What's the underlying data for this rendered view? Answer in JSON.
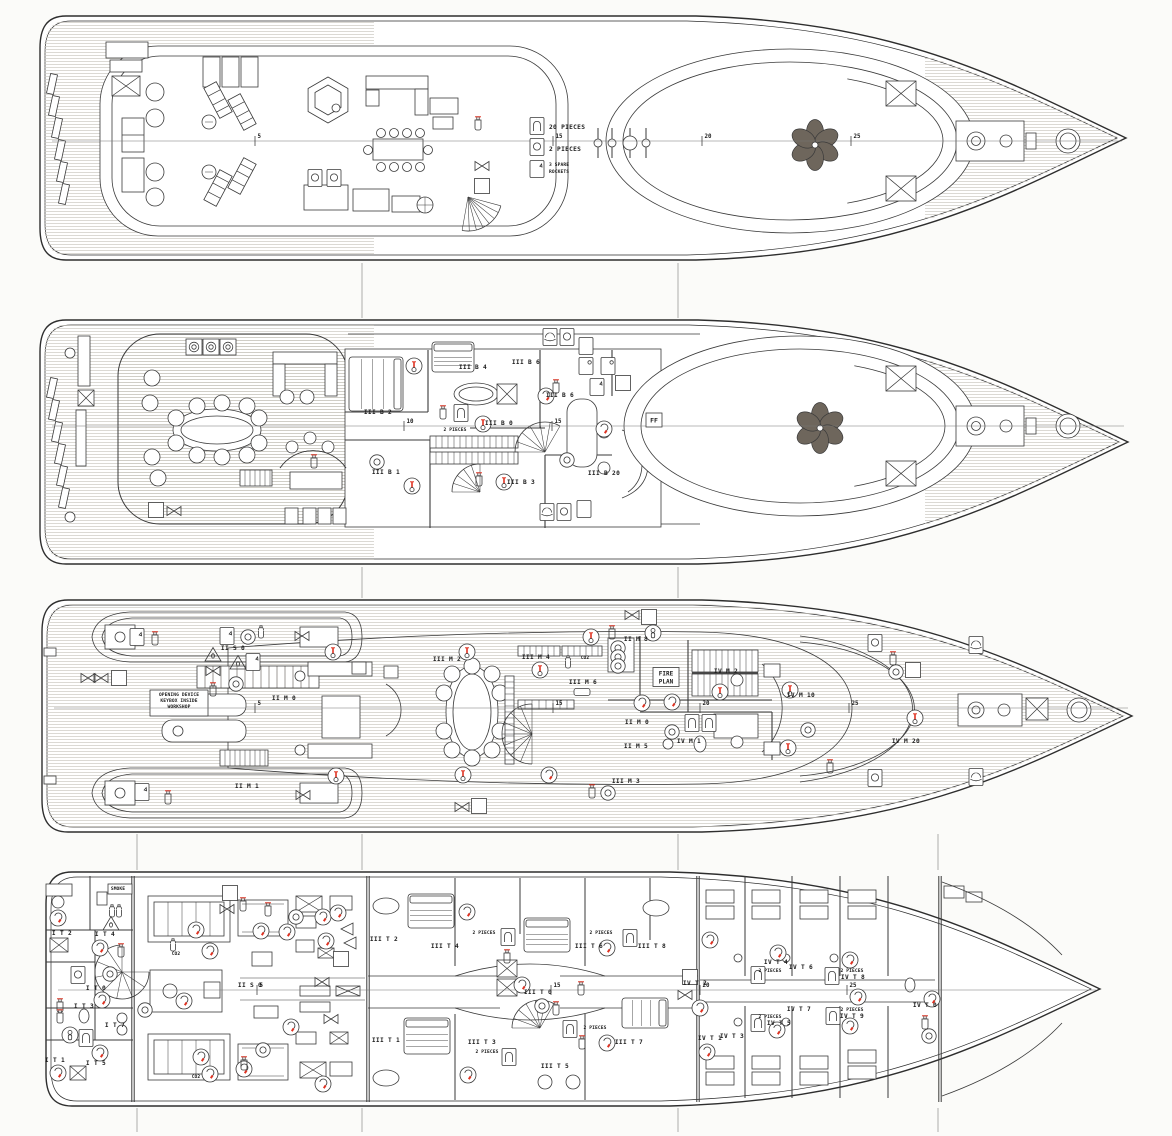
{
  "colors": {
    "line": "#3a3a3a",
    "red": "#df3222",
    "green": "#15673a",
    "green_dark": "#0c3f22",
    "blue": "#2f63b5",
    "band": "#50473e",
    "dark_furniture": "#6e665c",
    "yellow": "#edbd1a",
    "teak_line": "#c9c7bf",
    "paper": "#fbfbf9"
  },
  "symbol_key": {
    "ext": "fire-extinguisher-icon",
    "hose": "fire-hose-reel-icon",
    "hyd": "hydrant-valve-icon",
    "heat": "heat-detector-icon",
    "smoke": "smoke-detector-icon",
    "call": "alarm-call-point-icon",
    "callb": "alarm-call-point-icon",
    "co2": "co2-cylinder-icon",
    "ff": "fireman-outfit-icon",
    "tri": "fire-damper-icon",
    "blk": "emergency-shutoff-icon",
    "blue": "breathing-apparatus-icon",
    "g_lj": "lifejackets-locker-icon",
    "g_lb": "lifebuoy-icon",
    "g_lr": "liferaft-icon",
    "g_ladder": "escape-ladder-icon",
    "g_flare": "distress-rockets-icon",
    "g_lta": "line-throwing-appliance-icon",
    "g_exit": "emergency-exit-icon",
    "fireplan": "fire-plan-box-icon",
    "yellow": "first-aid-kit-icon"
  },
  "decks": [
    {
      "id": "deck-1",
      "centerline_y": 141,
      "frames": [
        {
          "n": "5",
          "x": 255
        },
        {
          "n": "15",
          "x": 553
        },
        {
          "n": "20",
          "x": 702
        },
        {
          "n": "25",
          "x": 851
        }
      ],
      "symbols": [
        [
          "ext",
          478,
          123
        ],
        [
          "hyd",
          482,
          166
        ],
        [
          "hose",
          482,
          186
        ],
        [
          "g_lj",
          537,
          126
        ],
        [
          "g_lb",
          537,
          147
        ],
        [
          "g_flare",
          537,
          169
        ],
        [
          "g_lb",
          315,
          178
        ],
        [
          "g_lb",
          334,
          178
        ]
      ],
      "labels": [
        [
          "20 PIECES",
          549,
          129,
          "s"
        ],
        [
          "2 PIECES",
          549,
          151,
          "s"
        ],
        [
          "3 SPARE",
          549,
          166,
          "s",
          "xs"
        ],
        [
          "ROCKETS",
          549,
          173,
          "s",
          "xs"
        ]
      ]
    },
    {
      "id": "deck-2",
      "centerline_y": 426,
      "frames": [
        {
          "n": "10",
          "x": 404
        },
        {
          "n": "15",
          "x": 552
        }
      ],
      "symbols": [
        [
          "callb",
          194,
          347
        ],
        [
          "callb",
          211,
          347
        ],
        [
          "callb",
          228,
          347
        ],
        [
          "heat",
          414,
          366
        ],
        [
          "smoke",
          546,
          396
        ],
        [
          "heat",
          483,
          424
        ],
        [
          "heat",
          412,
          486
        ],
        [
          "heat",
          504,
          482
        ],
        [
          "smoke",
          604,
          429
        ],
        [
          "call",
          377,
          462
        ],
        [
          "call",
          567,
          460
        ],
        [
          "ext",
          443,
          412
        ],
        [
          "ext",
          479,
          479
        ],
        [
          "ext",
          556,
          386
        ],
        [
          "ext",
          314,
          461
        ],
        [
          "hose",
          156,
          510
        ],
        [
          "hyd",
          174,
          511
        ],
        [
          "hose",
          623,
          383
        ],
        [
          "ff",
          654,
          420
        ],
        [
          "g_lj",
          461,
          413
        ],
        [
          "g_lr",
          550,
          337
        ],
        [
          "g_lb",
          567,
          337
        ],
        [
          "g_ladder",
          586,
          346
        ],
        [
          "g_lta",
          586,
          366
        ],
        [
          "g_lta",
          608,
          366
        ],
        [
          "g_flare",
          597,
          387
        ],
        [
          "g_lr",
          547,
          512
        ],
        [
          "g_lb",
          564,
          512
        ],
        [
          "g_ladder",
          584,
          509
        ]
      ],
      "labels": [
        [
          "III B 4",
          473,
          369
        ],
        [
          "III B 6",
          526,
          364
        ],
        [
          "III B 6",
          560,
          397
        ],
        [
          "III B 2",
          378,
          414
        ],
        [
          "III B 0",
          499,
          425
        ],
        [
          "2 PIECES",
          455,
          431,
          "m",
          "xs"
        ],
        [
          "III B 1",
          386,
          474
        ],
        [
          "III B 3",
          521,
          484
        ],
        [
          "III B 20",
          604,
          475
        ]
      ]
    },
    {
      "id": "deck-3",
      "centerline_y": 708,
      "frames": [
        {
          "n": "5",
          "x": 255
        },
        {
          "n": "15",
          "x": 553
        },
        {
          "n": "20",
          "x": 700
        },
        {
          "n": "25",
          "x": 849
        }
      ],
      "symbols": [
        [
          "g_exit",
          137,
          637
        ],
        [
          "g_exit",
          142,
          792
        ],
        [
          "ext",
          155,
          638
        ],
        [
          "ext",
          168,
          797
        ],
        [
          "hyd",
          88,
          678
        ],
        [
          "hyd",
          101,
          678
        ],
        [
          "hose",
          119,
          678
        ],
        [
          "g_exit",
          227,
          636
        ],
        [
          "call",
          248,
          637
        ],
        [
          "co2",
          261,
          633
        ],
        [
          "tri",
          213,
          655
        ],
        [
          "tri",
          238,
          663
        ],
        [
          "g_flare",
          253,
          662
        ],
        [
          "hyd",
          213,
          671
        ],
        [
          "ext",
          213,
          689
        ],
        [
          "call",
          236,
          684
        ],
        [
          "hyd",
          302,
          636
        ],
        [
          "hyd",
          303,
          795
        ],
        [
          "heat",
          333,
          652
        ],
        [
          "heat",
          336,
          776
        ],
        [
          "heat",
          467,
          652
        ],
        [
          "heat",
          463,
          775
        ],
        [
          "heat",
          540,
          670
        ],
        [
          "heat",
          591,
          637
        ],
        [
          "co2",
          568,
          663
        ],
        [
          "smoke",
          642,
          703
        ],
        [
          "smoke",
          672,
          702
        ],
        [
          "heat",
          720,
          692
        ],
        [
          "call",
          672,
          732
        ],
        [
          "smoke",
          549,
          775
        ],
        [
          "ext",
          592,
          791
        ],
        [
          "call",
          608,
          793
        ],
        [
          "heat",
          790,
          690
        ],
        [
          "call",
          808,
          730
        ],
        [
          "heat",
          788,
          748
        ],
        [
          "ext",
          830,
          766
        ],
        [
          "heat",
          915,
          718
        ],
        [
          "hyd",
          632,
          615
        ],
        [
          "hose",
          649,
          617
        ],
        [
          "hyd",
          462,
          807
        ],
        [
          "hose",
          479,
          806
        ],
        [
          "blue",
          653,
          633
        ],
        [
          "ext",
          612,
          632
        ],
        [
          "hose",
          913,
          670
        ],
        [
          "ext",
          893,
          658
        ],
        [
          "call",
          896,
          672
        ],
        [
          "g_lb",
          875,
          643
        ],
        [
          "g_lb",
          875,
          778
        ],
        [
          "g_lr",
          976,
          645
        ],
        [
          "g_lr",
          976,
          777
        ],
        [
          "g_lj",
          692,
          723
        ],
        [
          "g_lj",
          709,
          723
        ],
        [
          "call",
          618,
          648
        ],
        [
          "call",
          618,
          657
        ],
        [
          "call",
          618,
          666
        ],
        [
          "fireplan",
          666,
          677
        ],
        [
          "yellow",
          582,
          692
        ]
      ],
      "labels": [
        [
          "OPENING DEVICE",
          179,
          696,
          "m",
          "xs"
        ],
        [
          "KEYBOX INSIDE",
          179,
          702,
          "m",
          "xs"
        ],
        [
          "WORKSHOP",
          179,
          708,
          "m",
          "xs"
        ],
        [
          "II S 0",
          233,
          650
        ],
        [
          "II M 0",
          284,
          700
        ],
        [
          "II M 1",
          247,
          788
        ],
        [
          "III M 2",
          447,
          661
        ],
        [
          "III M 4",
          536,
          659
        ],
        [
          "CO2",
          585,
          659,
          "m",
          "xs"
        ],
        [
          "III M 6",
          583,
          684
        ],
        [
          "II M 8",
          636,
          641
        ],
        [
          "IV M 2",
          726,
          673
        ],
        [
          "IV M 10",
          801,
          697
        ],
        [
          "IV M 1",
          689,
          743
        ],
        [
          "II M 0",
          637,
          724
        ],
        [
          "II M 5",
          636,
          748
        ],
        [
          "III M 3",
          626,
          783
        ],
        [
          "IV M 20",
          906,
          743
        ]
      ]
    },
    {
      "id": "deck-4",
      "centerline_y": 990,
      "frames": [
        {
          "n": "5",
          "x": 257
        },
        {
          "n": "15",
          "x": 551
        },
        {
          "n": "20",
          "x": 700
        },
        {
          "n": "25",
          "x": 847
        }
      ],
      "symbols": [
        [
          "smoke",
          58,
          918
        ],
        [
          "co2",
          112,
          912
        ],
        [
          "co2",
          119,
          912
        ],
        [
          "tri",
          111,
          924
        ],
        [
          "smoke",
          100,
          948
        ],
        [
          "ext",
          121,
          950
        ],
        [
          "g_lb",
          78,
          975
        ],
        [
          "call",
          110,
          974
        ],
        [
          "smoke",
          102,
          1000
        ],
        [
          "blue",
          70,
          1035
        ],
        [
          "g_lj",
          86,
          1038
        ],
        [
          "ext",
          60,
          1005
        ],
        [
          "ext",
          60,
          1016
        ],
        [
          "smoke",
          100,
          1053
        ],
        [
          "smoke",
          58,
          1073
        ],
        [
          "call",
          145,
          1010
        ],
        [
          "smoke",
          184,
          1001
        ],
        [
          "hose",
          230,
          893
        ],
        [
          "hyd",
          227,
          909
        ],
        [
          "smoke",
          196,
          930
        ],
        [
          "smoke",
          210,
          951
        ],
        [
          "ext",
          243,
          904
        ],
        [
          "smoke",
          261,
          931
        ],
        [
          "ext",
          268,
          909
        ],
        [
          "smoke",
          287,
          932
        ],
        [
          "call",
          296,
          917
        ],
        [
          "smoke",
          323,
          917
        ],
        [
          "smoke",
          338,
          913
        ],
        [
          "blk",
          347,
          929
        ],
        [
          "blk",
          350,
          943
        ],
        [
          "smoke",
          326,
          941
        ],
        [
          "hose",
          341,
          959
        ],
        [
          "hyd",
          322,
          982
        ],
        [
          "hyd",
          331,
          1019
        ],
        [
          "smoke",
          201,
          1057
        ],
        [
          "smoke",
          210,
          1074
        ],
        [
          "smoke",
          244,
          1069
        ],
        [
          "call",
          263,
          1050
        ],
        [
          "ext",
          244,
          1063
        ],
        [
          "smoke",
          291,
          1027
        ],
        [
          "smoke",
          323,
          1084
        ],
        [
          "co2",
          173,
          946
        ],
        [
          "smoke",
          467,
          912
        ],
        [
          "g_lj",
          508,
          937
        ],
        [
          "ext",
          507,
          956
        ],
        [
          "smoke",
          522,
          985
        ],
        [
          "call",
          542,
          1006
        ],
        [
          "ext",
          556,
          1008
        ],
        [
          "g_lj",
          570,
          1029
        ],
        [
          "ext",
          581,
          988
        ],
        [
          "ext",
          582,
          1042
        ],
        [
          "smoke",
          607,
          948
        ],
        [
          "smoke",
          607,
          1043
        ],
        [
          "g_lj",
          509,
          1057
        ],
        [
          "smoke",
          468,
          1075
        ],
        [
          "g_lj",
          630,
          938
        ],
        [
          "hose",
          690,
          977
        ],
        [
          "hyd",
          685,
          995
        ],
        [
          "smoke",
          710,
          940
        ],
        [
          "smoke",
          778,
          953
        ],
        [
          "smoke",
          850,
          960
        ],
        [
          "smoke",
          700,
          1008
        ],
        [
          "smoke",
          777,
          1030
        ],
        [
          "smoke",
          850,
          1026
        ],
        [
          "smoke",
          858,
          997
        ],
        [
          "smoke",
          932,
          999
        ],
        [
          "smoke",
          707,
          1052
        ],
        [
          "g_lj",
          758,
          975
        ],
        [
          "g_lj",
          832,
          976
        ],
        [
          "g_lj",
          833,
          1016
        ],
        [
          "g_lj",
          758,
          1023
        ],
        [
          "ext",
          925,
          1022
        ],
        [
          "call",
          929,
          1036
        ]
      ],
      "labels": [
        [
          "SMOKE",
          118,
          890,
          "m",
          "xs"
        ],
        [
          "CO2",
          176,
          955,
          "m",
          "xs"
        ],
        [
          "CO2",
          196,
          1078,
          "m",
          "xs"
        ],
        [
          "II S 0",
          250,
          987
        ],
        [
          "I T 2",
          62,
          935
        ],
        [
          "I T 4",
          105,
          936
        ],
        [
          "I T 0",
          96,
          990
        ],
        [
          "I T 3",
          84,
          1008
        ],
        [
          "I T 7",
          115,
          1027
        ],
        [
          "I T 1",
          55,
          1062
        ],
        [
          "I T 5",
          96,
          1065
        ],
        [
          "III T 2",
          384,
          941
        ],
        [
          "III T 4",
          445,
          948
        ],
        [
          "2 PIECES",
          484,
          934,
          "m",
          "xs"
        ],
        [
          "III T 6",
          589,
          948
        ],
        [
          "2 PIECES",
          601,
          934,
          "m",
          "xs"
        ],
        [
          "III T 8",
          652,
          948
        ],
        [
          "III T 0",
          538,
          994
        ],
        [
          "III T 1",
          386,
          1042
        ],
        [
          "III T 3",
          482,
          1044
        ],
        [
          "2 PIECES",
          487,
          1053,
          "m",
          "xs"
        ],
        [
          "III T 5",
          555,
          1068
        ],
        [
          "III T 7",
          629,
          1044
        ],
        [
          "2 PIECES",
          595,
          1029,
          "m",
          "xs"
        ],
        [
          "IV T 4",
          776,
          964
        ],
        [
          "2 PIECES",
          770,
          972,
          "m",
          "xs"
        ],
        [
          "IV T 6",
          801,
          969
        ],
        [
          "2 PIECES",
          852,
          972,
          "m",
          "xs"
        ],
        [
          "IV T 8",
          853,
          979
        ],
        [
          "IV T 2",
          695,
          985
        ],
        [
          "IV T 0",
          925,
          1007
        ],
        [
          "2 PIECES",
          852,
          1011,
          "m",
          "xs"
        ],
        [
          "IV T 9",
          852,
          1018
        ],
        [
          "2 PIECES",
          770,
          1018,
          "m",
          "xs"
        ],
        [
          "IV T 5",
          779,
          1025
        ],
        [
          "IV T 7",
          799,
          1011
        ],
        [
          "IV T 1",
          710,
          1040
        ],
        [
          "IV T 3",
          732,
          1038
        ]
      ]
    }
  ]
}
